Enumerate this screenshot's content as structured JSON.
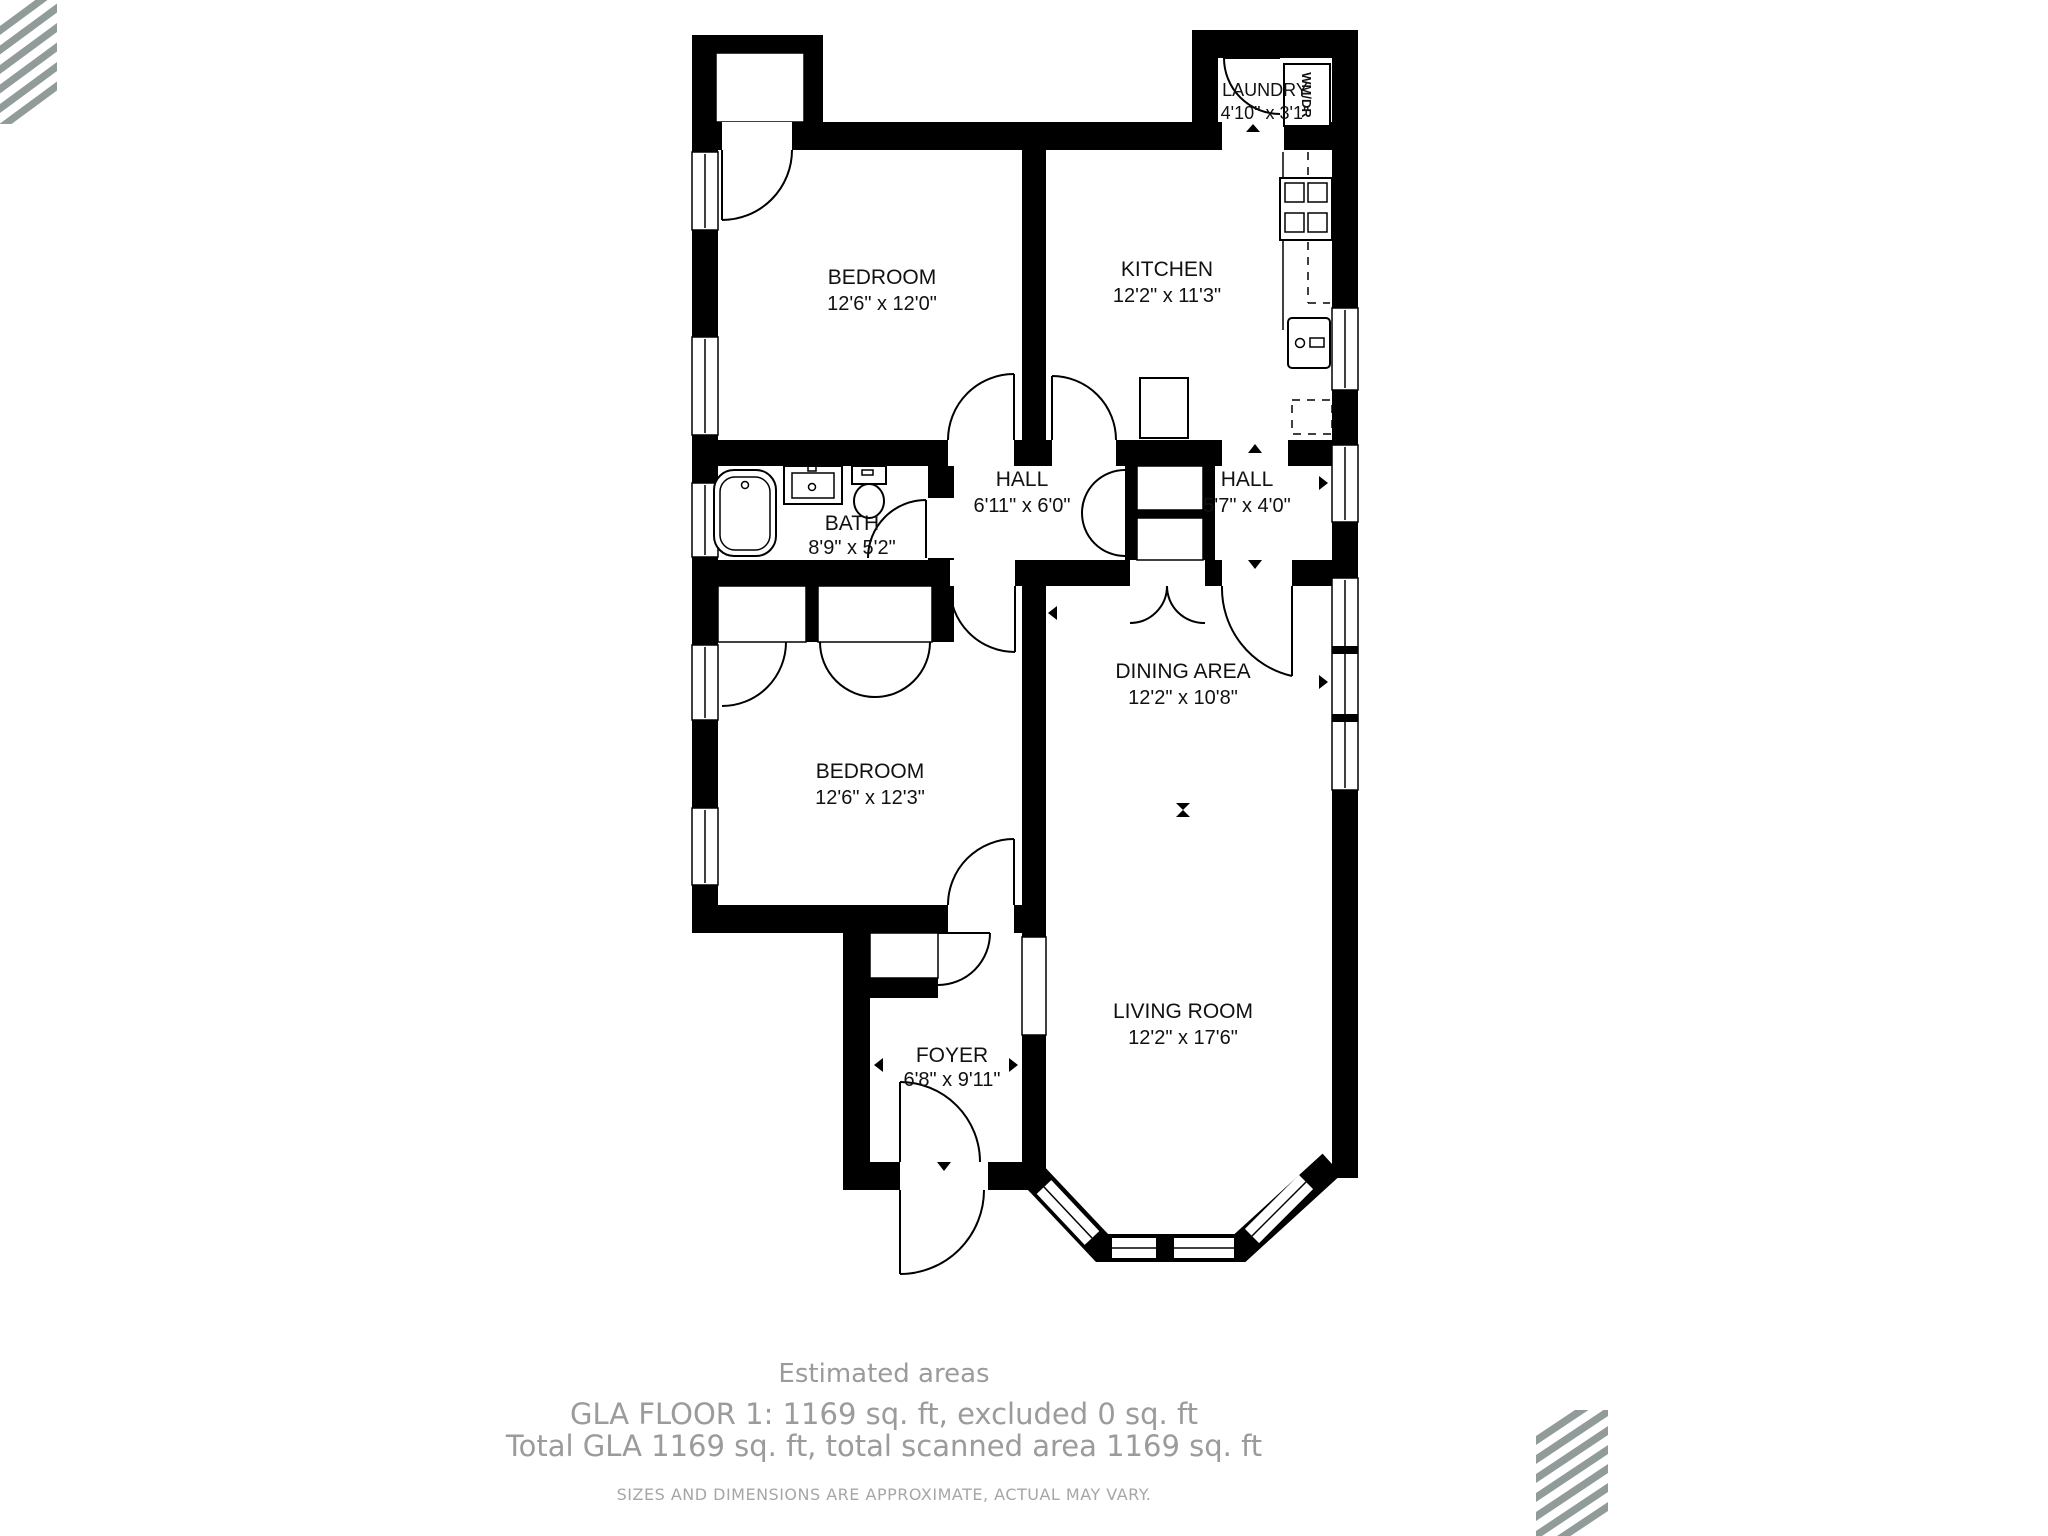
{
  "floorplan": {
    "rooms": [
      {
        "name": "LAUNDRY",
        "dims": "4'10\" x 3'1\""
      },
      {
        "name": "BEDROOM",
        "dims": "12'6\" x 12'0\""
      },
      {
        "name": "KITCHEN",
        "dims": "12'2\" x 11'3\""
      },
      {
        "name": "HALL",
        "dims": "6'11\" x 6'0\""
      },
      {
        "name": "HALL",
        "dims": "5'7\" x 4'0\""
      },
      {
        "name": "BATH",
        "dims": "8'9\" x 5'2\""
      },
      {
        "name": "BEDROOM",
        "dims": "12'6\" x 12'3\""
      },
      {
        "name": "DINING AREA",
        "dims": "12'2\" x 10'8\""
      },
      {
        "name": "LIVING ROOM",
        "dims": "12'2\" x 17'6\""
      },
      {
        "name": "FOYER",
        "dims": "6'8\" x 9'11\""
      }
    ],
    "appliances": {
      "washer_dryer": "WM/DR"
    }
  },
  "footer": {
    "estimated_areas_title": "Estimated areas",
    "gla_line1": "GLA FLOOR 1: 1169 sq. ft, excluded 0 sq. ft",
    "gla_line2": "Total GLA 1169 sq. ft, total scanned area 1169 sq. ft",
    "disclaimer": "SIZES AND DIMENSIONS ARE APPROXIMATE, ACTUAL MAY VARY."
  },
  "branding": {
    "logo": "diagonal-stripes",
    "stripe_color": "#919b9a"
  },
  "colors": {
    "wall": "#000000",
    "background": "#ffffff",
    "footer_text": "#9b9b9b"
  }
}
